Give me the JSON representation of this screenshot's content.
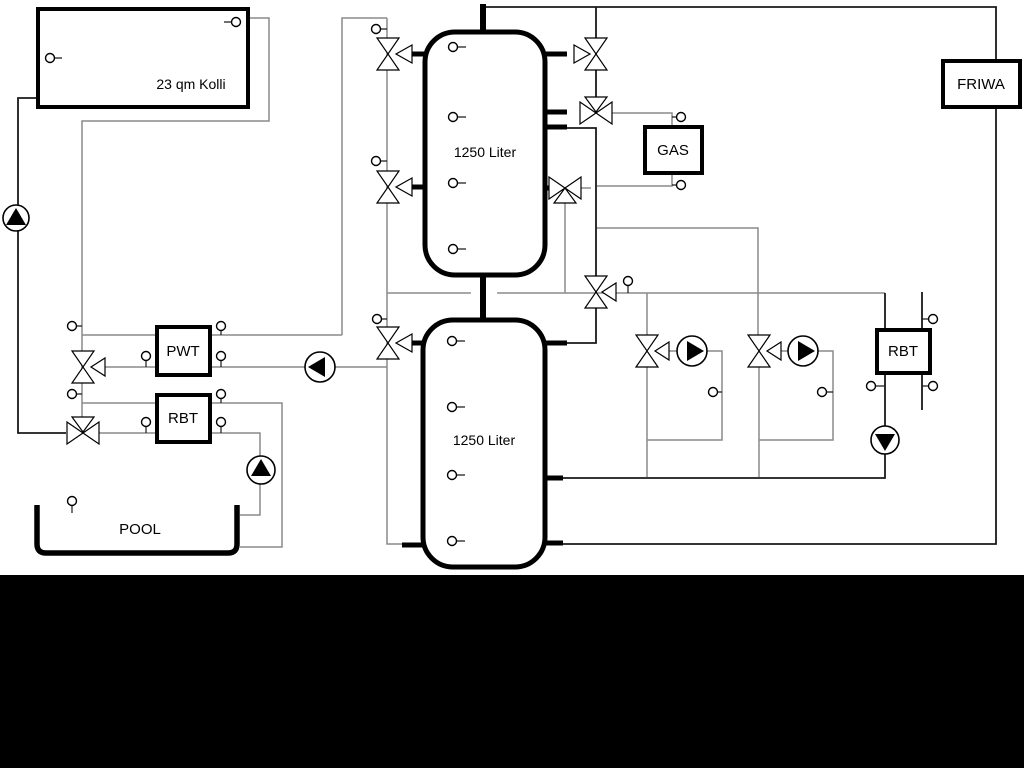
{
  "diagram": {
    "title": "heating-system-hydraulic-schematic",
    "labels": {
      "collector": "23 qm Kolli",
      "tank_top": "1250 Liter",
      "tank_bottom": "1250 Liter",
      "gas": "GAS",
      "friwa": "FRIWA",
      "pwt": "PWT",
      "rbt_left": "RBT",
      "rbt_right": "RBT",
      "pool": "POOL"
    },
    "colors": {
      "background": "#ffffff",
      "pipe_gray": "#8a8a8a",
      "pipe_black": "#1a1a1a",
      "component_outline": "#000000",
      "bottom_band": "#000000"
    },
    "components": {
      "three_way_valves": 11,
      "pumps": 6,
      "temperature_sensors": 30
    }
  }
}
